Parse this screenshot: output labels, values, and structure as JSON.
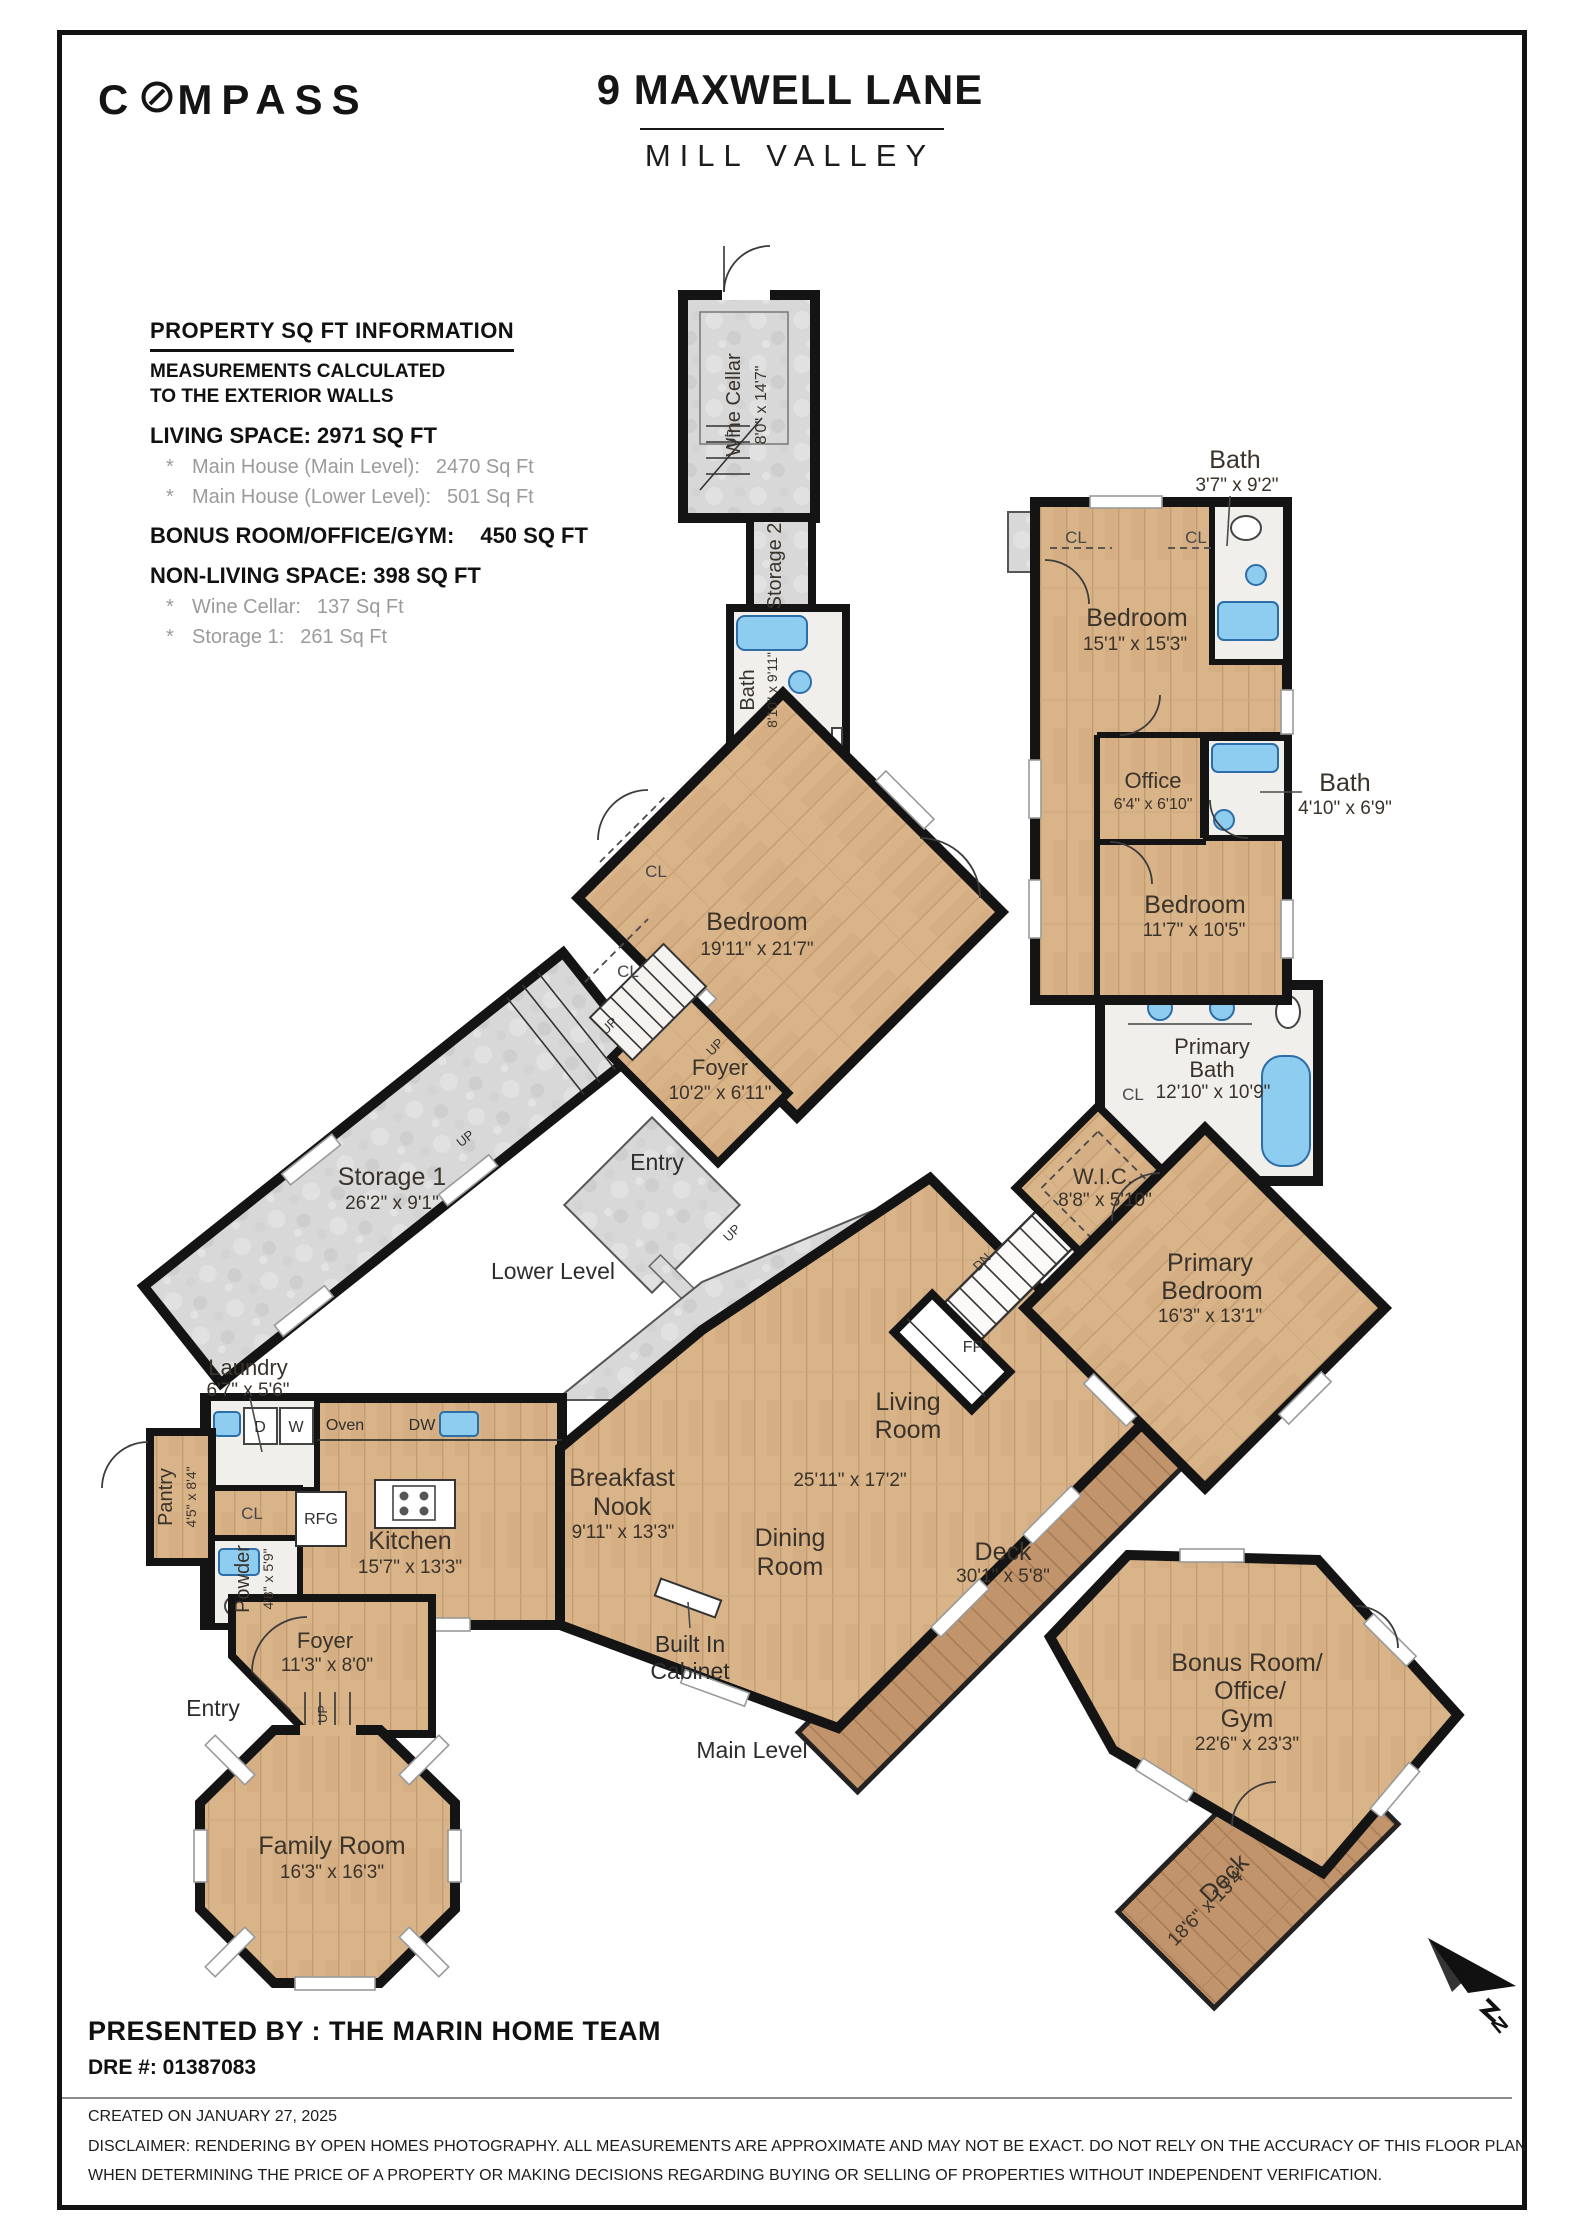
{
  "colors": {
    "wall": "#141414",
    "wood": "#d9b489",
    "wood_deck": "#c1946b",
    "stone": "#d8d8d8",
    "bath_floor": "#f1efec",
    "fixture_blue": "#8ecdf0",
    "label_text": "#3a332b"
  },
  "header": {
    "brand": "COMPASS",
    "title": "9 MAXWELL LANE",
    "subtitle": "MILL VALLEY"
  },
  "info": {
    "heading": "PROPERTY SQ FT INFORMATION",
    "sub_line1": "MEASUREMENTS CALCULATED",
    "sub_line2": "TO THE EXTERIOR WALLS",
    "living_heading": "LIVING SPACE: 2971 SQ FT",
    "bullet": "*",
    "living_items": [
      {
        "label": "Main House (Main Level):",
        "value": "2470 Sq Ft"
      },
      {
        "label": "Main House (Lower Level):",
        "value": "501 Sq Ft"
      }
    ],
    "bonus_heading": "BONUS ROOM/OFFICE/GYM:",
    "bonus_value": "450 SQ FT",
    "nonliving_heading": "NON-LIVING SPACE: 398 SQ FT",
    "nonliving_items": [
      {
        "label": "Wine Cellar:",
        "value": "137 Sq Ft"
      },
      {
        "label": "Storage 1:",
        "value": "261 Sq Ft"
      }
    ]
  },
  "levels": {
    "lower": "Lower Level",
    "main": "Main Level"
  },
  "rooms": {
    "wine_cellar": {
      "name": "Wine Cellar",
      "dims": "8'0\" x 14'7\""
    },
    "storage2": {
      "name": "Storage 2"
    },
    "bath_lower": {
      "name": "Bath",
      "dims": "8'10\" x 9'11\""
    },
    "bedroom_lower": {
      "name": "Bedroom",
      "dims": "19'11\" x 21'7\""
    },
    "foyer_lower": {
      "name": "Foyer",
      "dims": "10'2\" x 6'11\""
    },
    "storage1": {
      "name": "Storage 1",
      "dims": "26'2\" x 9'1\""
    },
    "entry": {
      "label": "Entry"
    },
    "laundry": {
      "name": "Laundry",
      "dims": "6'7\" x 5'6\""
    },
    "pantry": {
      "name": "Pantry",
      "dims": "4'5\" x 8'4\""
    },
    "powder": {
      "name": "Powder",
      "dims": "4'8\" x 5'9\""
    },
    "kitchen": {
      "name": "Kitchen",
      "dims": "15'7\" x 13'3\""
    },
    "foyer_main": {
      "name": "Foyer",
      "dims": "11'3\" x 8'0\""
    },
    "family": {
      "name": "Family Room",
      "dims": "16'3\" x 16'3\""
    },
    "breakfast": {
      "line1": "Breakfast",
      "line2": "Nook",
      "dims": "9'11\" x 13'3\""
    },
    "dining": {
      "line1": "Dining",
      "line2": "Room"
    },
    "living": {
      "line1": "Living",
      "line2": "Room",
      "dims": "25'11\" x 17'2\""
    },
    "builtin": {
      "line1": "Built In",
      "line2": "Cabinet"
    },
    "deck_main": {
      "name": "Deck",
      "dims": "30'1\" x 5'8\""
    },
    "primary_bath": {
      "line1": "Primary",
      "line2": "Bath",
      "dims": "12'10\" x 10'9\""
    },
    "wic": {
      "name": "W.I.C.",
      "dims": "8'8\" x 5'10\""
    },
    "primary_bedroom": {
      "line1": "Primary",
      "line2": "Bedroom",
      "dims": "16'3\" x 13'1\""
    },
    "bedroom_15": {
      "name": "Bedroom",
      "dims": "15'1\" x 15'3\""
    },
    "bath_37": {
      "name": "Bath",
      "dims": "3'7\" x 9'2\""
    },
    "office": {
      "name": "Office",
      "dims": "6'4\" x 6'10\""
    },
    "bath_410": {
      "name": "Bath",
      "dims": "4'10\" x 6'9\""
    },
    "bedroom_11": {
      "name": "Bedroom",
      "dims": "11'7\" x 10'5\""
    },
    "bonus": {
      "line1": "Bonus Room/",
      "line2": "Office/",
      "line3": "Gym",
      "dims": "22'6\" x 23'3\""
    },
    "deck_bonus": {
      "name": "Deck",
      "dims": "18'6\" x 13'4\""
    }
  },
  "markers": {
    "cl": "CL",
    "up": "UP",
    "dn": "DN",
    "fp": "FP",
    "d": "D",
    "w": "W",
    "oven": "Oven",
    "dw": "DW",
    "rfg": "RFG",
    "north": "N"
  },
  "footer": {
    "presented": "PRESENTED BY : THE MARIN HOME TEAM",
    "dre": "DRE #: 01387083",
    "created": "CREATED ON JANUARY 27, 2025",
    "disclaimer_line1": "DISCLAIMER: RENDERING BY OPEN HOMES PHOTOGRAPHY. ALL MEASUREMENTS ARE APPROXIMATE AND MAY NOT BE EXACT. DO NOT RELY ON THE ACCURACY OF THIS FLOOR PLAN",
    "disclaimer_line2": "WHEN DETERMINING THE PRICE OF A PROPERTY OR MAKING DECISIONS REGARDING BUYING OR SELLING OF PROPERTIES WITHOUT INDEPENDENT VERIFICATION."
  }
}
